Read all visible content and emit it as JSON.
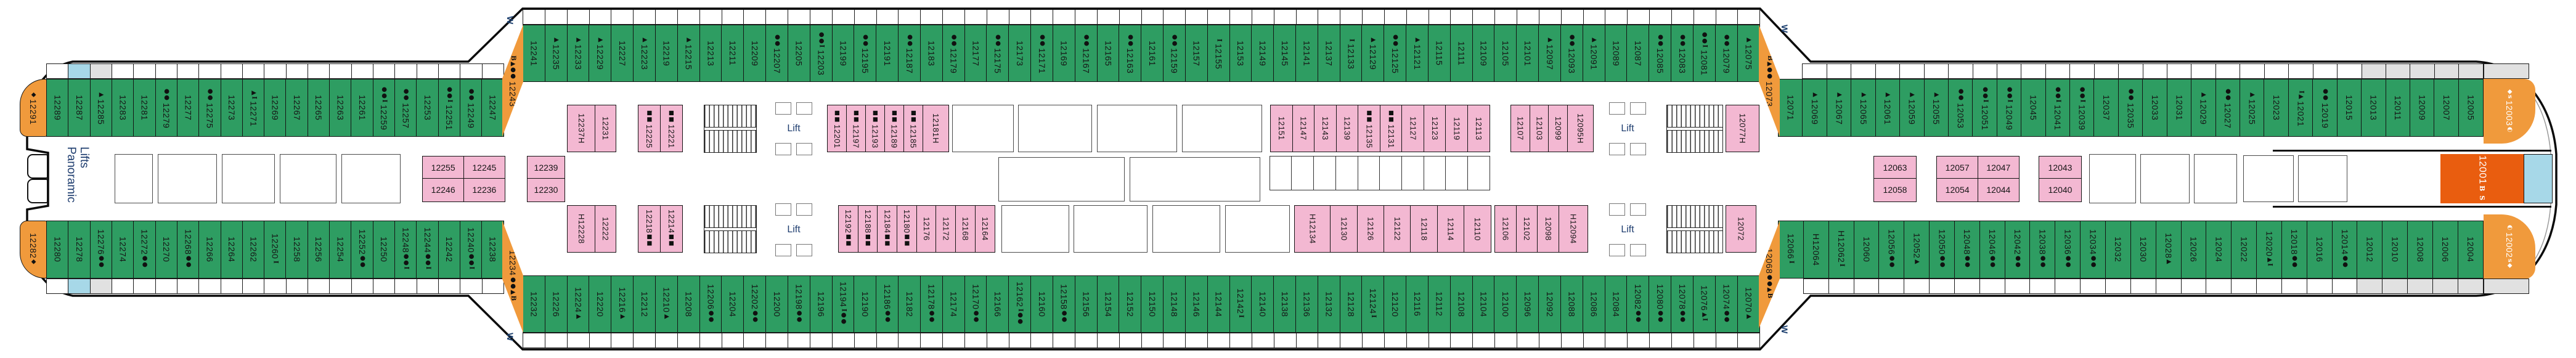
{
  "labels": {
    "panoramic_line1": "Panoramic",
    "panoramic_line2": "Lifts",
    "lift": "Lift",
    "w_mark": "W"
  },
  "colors": {
    "balcony_green": "#2e9d62",
    "inside_pink": "#f3b8d2",
    "suite_orange": "#f09a3c",
    "suite_deluxe": "#e95d0f",
    "highlight_blue": "#a7d8e8",
    "muted_gray": "#e1e1e1"
  },
  "rows": {
    "tl": {
      "base": "green",
      "cabins": [
        {
          "n": "12289"
        },
        {
          "n": "12287",
          "bal": "blue"
        },
        {
          "n": "12285",
          "pre": "▲",
          "bal": "gray"
        },
        {
          "n": "12283"
        },
        {
          "n": "12281"
        },
        {
          "n": "12279",
          "pre": "●●"
        },
        {
          "n": "12277"
        },
        {
          "n": "12275",
          "pre": "●●"
        },
        {
          "n": "12273"
        },
        {
          "n": "12271",
          "pre": "▲Ⅰ"
        },
        {
          "n": "12269"
        },
        {
          "n": "12267"
        },
        {
          "n": "12265"
        },
        {
          "n": "12263"
        },
        {
          "n": "12261"
        },
        {
          "n": "12259",
          "pre": "●●Ⅰ"
        },
        {
          "n": "12257",
          "pre": "●●"
        },
        {
          "n": "12253"
        },
        {
          "n": "12251",
          "pre": "●●Ⅰ"
        },
        {
          "n": "12249",
          "pre": "●●"
        },
        {
          "n": "12247"
        }
      ]
    },
    "tm": {
      "base": "green",
      "cabins": [
        {
          "n": "12241"
        },
        {
          "n": "12235",
          "pre": "▲"
        },
        {
          "n": "12233",
          "pre": "▲"
        },
        {
          "n": "12229",
          "pre": "▲"
        },
        {
          "n": "12227"
        },
        {
          "n": "12223",
          "pre": "▲"
        },
        {
          "n": "12219"
        },
        {
          "n": "12215",
          "pre": "▲"
        },
        {
          "n": "12213"
        },
        {
          "n": "12211"
        },
        {
          "n": "12209"
        },
        {
          "n": "12207",
          "pre": "●●"
        },
        {
          "n": "12205"
        },
        {
          "n": "12203",
          "pre": "●●Ⅰ"
        },
        {
          "n": "12199"
        },
        {
          "n": "12195",
          "pre": "●●"
        },
        {
          "n": "12191"
        },
        {
          "n": "12187",
          "pre": "●●"
        },
        {
          "n": "12183"
        },
        {
          "n": "12179",
          "pre": "●●"
        },
        {
          "n": "12177"
        },
        {
          "n": "12175",
          "pre": "●●"
        },
        {
          "n": "12173"
        },
        {
          "n": "12171",
          "pre": "●●"
        },
        {
          "n": "12169"
        },
        {
          "n": "12167",
          "pre": "●●"
        },
        {
          "n": "12165"
        },
        {
          "n": "12163",
          "pre": "●●"
        },
        {
          "n": "12161"
        },
        {
          "n": "12159",
          "pre": "●●"
        },
        {
          "n": "12157"
        },
        {
          "n": "12155",
          "pre": "Ⅰ"
        },
        {
          "n": "12153"
        },
        {
          "n": "12149"
        },
        {
          "n": "12145"
        },
        {
          "n": "12141"
        },
        {
          "n": "12137"
        },
        {
          "n": "12133",
          "pre": "Ⅰ"
        },
        {
          "n": "12129",
          "pre": "▲"
        },
        {
          "n": "12125",
          "pre": "●●"
        },
        {
          "n": "12121",
          "pre": "▲"
        },
        {
          "n": "12115"
        },
        {
          "n": "12111"
        },
        {
          "n": "12109"
        },
        {
          "n": "12105"
        },
        {
          "n": "12101"
        },
        {
          "n": "12097",
          "pre": "▲"
        },
        {
          "n": "12093",
          "pre": "●●"
        },
        {
          "n": "12091",
          "pre": "▲"
        },
        {
          "n": "12089"
        },
        {
          "n": "12087"
        },
        {
          "n": "12085",
          "pre": "●●"
        },
        {
          "n": "12083",
          "pre": "●●"
        },
        {
          "n": "12081",
          "pre": "●●Ⅰ"
        },
        {
          "n": "12079",
          "pre": "●●"
        },
        {
          "n": "12075",
          "pre": "▲"
        }
      ]
    },
    "tr": {
      "base": "green",
      "cabins": [
        {
          "n": "12071",
          "nobal": true
        },
        {
          "n": "12069",
          "pre": "▲"
        },
        {
          "n": "12067",
          "pre": "▲"
        },
        {
          "n": "12065",
          "pre": "▲"
        },
        {
          "n": "12061",
          "pre": "▲"
        },
        {
          "n": "12059",
          "pre": "▲"
        },
        {
          "n": "12055",
          "pre": "▲"
        },
        {
          "n": "12053",
          "pre": "●●"
        },
        {
          "n": "12051",
          "pre": "●●Ⅰ"
        },
        {
          "n": "12049",
          "pre": "●●Ⅰ"
        },
        {
          "n": "12045"
        },
        {
          "n": "12041",
          "pre": "●●Ⅰ"
        },
        {
          "n": "12039",
          "pre": "●●Ⅰ"
        },
        {
          "n": "12037"
        },
        {
          "n": "12035",
          "pre": "●●"
        },
        {
          "n": "12033"
        },
        {
          "n": "12031"
        },
        {
          "n": "12029",
          "pre": "▲"
        },
        {
          "n": "12027",
          "pre": "●●"
        },
        {
          "n": "12025",
          "pre": "▲"
        },
        {
          "n": "12023"
        },
        {
          "n": "12021",
          "pre": "Ⅰ▲"
        },
        {
          "n": "12019",
          "pre": "●●"
        },
        {
          "n": "12015"
        },
        {
          "n": "12013",
          "bal": "gray"
        },
        {
          "n": "12011",
          "bal": "gray"
        },
        {
          "n": "12009",
          "bal": "gray"
        },
        {
          "n": "12007",
          "bal": "gray"
        },
        {
          "n": "12005",
          "bal": "gray"
        }
      ]
    },
    "bl": {
      "base": "green",
      "cabins": [
        {
          "n": "12280"
        },
        {
          "n": "12278",
          "bal": "blue"
        },
        {
          "n": "12276",
          "suf": "●●",
          "bal": "gray"
        },
        {
          "n": "12274"
        },
        {
          "n": "12272",
          "suf": "●●"
        },
        {
          "n": "12270"
        },
        {
          "n": "12268",
          "suf": "●●"
        },
        {
          "n": "12266"
        },
        {
          "n": "12264"
        },
        {
          "n": "12262"
        },
        {
          "n": "12260",
          "suf": "Ⅰ"
        },
        {
          "n": "12258"
        },
        {
          "n": "12256"
        },
        {
          "n": "12254"
        },
        {
          "n": "12252",
          "suf": "●●"
        },
        {
          "n": "12250"
        },
        {
          "n": "12248",
          "suf": "●●Ⅰ"
        },
        {
          "n": "12244",
          "suf": "●●Ⅰ"
        },
        {
          "n": "12242"
        },
        {
          "n": "12240",
          "suf": "●●Ⅰ"
        },
        {
          "n": "12238"
        }
      ]
    },
    "bm": {
      "base": "green",
      "cabins": [
        {
          "n": "12232"
        },
        {
          "n": "12226"
        },
        {
          "n": "12224",
          "suf": "▲"
        },
        {
          "n": "12220"
        },
        {
          "n": "12216",
          "suf": "▲"
        },
        {
          "n": "12212"
        },
        {
          "n": "12210",
          "suf": "▲"
        },
        {
          "n": "12208"
        },
        {
          "n": "12206",
          "suf": "●●"
        },
        {
          "n": "12204"
        },
        {
          "n": "12202",
          "suf": "●●"
        },
        {
          "n": "12200"
        },
        {
          "n": "12198",
          "suf": "●●"
        },
        {
          "n": "12196"
        },
        {
          "n": "12194",
          "suf": "Ⅰ●●"
        },
        {
          "n": "12190"
        },
        {
          "n": "12186",
          "suf": "●●"
        },
        {
          "n": "12182"
        },
        {
          "n": "12178",
          "suf": "●●"
        },
        {
          "n": "12174"
        },
        {
          "n": "12170",
          "suf": "●●"
        },
        {
          "n": "12166"
        },
        {
          "n": "12162",
          "suf": "Ⅰ●●"
        },
        {
          "n": "12160"
        },
        {
          "n": "12158",
          "suf": "●●"
        },
        {
          "n": "12156"
        },
        {
          "n": "12154"
        },
        {
          "n": "12152"
        },
        {
          "n": "12150"
        },
        {
          "n": "12148"
        },
        {
          "n": "12146"
        },
        {
          "n": "12144"
        },
        {
          "n": "12142",
          "suf": "Ⅰ"
        },
        {
          "n": "12140"
        },
        {
          "n": "12138"
        },
        {
          "n": "12136"
        },
        {
          "n": "12132"
        },
        {
          "n": "12128"
        },
        {
          "n": "12124",
          "suf": "Ⅰ"
        },
        {
          "n": "12120"
        },
        {
          "n": "12116"
        },
        {
          "n": "12112"
        },
        {
          "n": "12108"
        },
        {
          "n": "12104"
        },
        {
          "n": "12100"
        },
        {
          "n": "12096"
        },
        {
          "n": "12092"
        },
        {
          "n": "12088"
        },
        {
          "n": "12086"
        },
        {
          "n": "12084"
        },
        {
          "n": "12082",
          "suf": "●●"
        },
        {
          "n": "12080",
          "suf": "●●"
        },
        {
          "n": "12078",
          "suf": "●●"
        },
        {
          "n": "12076",
          "suf": "▲Ⅰ"
        },
        {
          "n": "12074",
          "suf": "●●"
        },
        {
          "n": "12070",
          "suf": "▲"
        }
      ]
    },
    "br": {
      "base": "green",
      "cabins": [
        {
          "n": "12066",
          "suf": "Ⅰ",
          "nobal": true
        },
        {
          "n": "12064",
          "H": "pre"
        },
        {
          "n": "12062",
          "H": "pre",
          "suf": "Ⅰ"
        },
        {
          "n": "12060"
        },
        {
          "n": "12056",
          "suf": "●●"
        },
        {
          "n": "12052",
          "suf": "▲"
        },
        {
          "n": "12050",
          "suf": "●●"
        },
        {
          "n": "12048",
          "suf": "●●"
        },
        {
          "n": "12046",
          "suf": "●●"
        },
        {
          "n": "12042",
          "suf": "●●"
        },
        {
          "n": "12038",
          "suf": "●●"
        },
        {
          "n": "12036",
          "suf": "●●"
        },
        {
          "n": "12034",
          "suf": "●●"
        },
        {
          "n": "12032"
        },
        {
          "n": "12030"
        },
        {
          "n": "12028",
          "suf": "▲"
        },
        {
          "n": "12026"
        },
        {
          "n": "12024"
        },
        {
          "n": "12022"
        },
        {
          "n": "12020",
          "suf": "▲Ⅰ"
        },
        {
          "n": "12018",
          "suf": "●●"
        },
        {
          "n": "12016"
        },
        {
          "n": "12014",
          "suf": "●●"
        },
        {
          "n": "12012",
          "bal": "gray"
        },
        {
          "n": "12010",
          "bal": "gray"
        },
        {
          "n": "12008",
          "bal": "gray"
        },
        {
          "n": "12006",
          "bal": "gray"
        },
        {
          "n": "12004",
          "bal": "gray"
        }
      ]
    }
  },
  "pink_top_blocks": [
    {
      "cabins": [
        {
          "n": "12237",
          "H": "suf",
          "fw": 1.35
        },
        {
          "n": "12231"
        }
      ]
    },
    {
      "cabins": [
        {
          "n": "12225",
          "pre": "■■"
        },
        {
          "n": "12221",
          "pre": "■■"
        }
      ]
    },
    {
      "cabins": [
        {
          "n": "12201",
          "pre": "■■"
        },
        {
          "n": "12197",
          "pre": "■■"
        },
        {
          "n": "12193",
          "pre": "■■"
        },
        {
          "n": "12189",
          "pre": "■■"
        },
        {
          "n": "12185",
          "pre": "■■"
        },
        {
          "n": "12181",
          "H": "suf",
          "fw": 1.35
        }
      ]
    },
    {
      "cabins": [
        {
          "n": "12151"
        },
        {
          "n": "12147"
        },
        {
          "n": "12143"
        },
        {
          "n": "12139"
        },
        {
          "n": "12135",
          "pre": "■■"
        },
        {
          "n": "12131",
          "pre": "■■"
        },
        {
          "n": "12127"
        },
        {
          "n": "12123"
        },
        {
          "n": "12119"
        },
        {
          "n": "12113"
        }
      ]
    },
    {
      "cabins": [
        {
          "n": "12107"
        },
        {
          "n": "12103"
        },
        {
          "n": "12099"
        },
        {
          "n": "12095",
          "H": "suf",
          "fw": 1.35
        }
      ]
    },
    {
      "cabins": [
        {
          "n": "12077",
          "H": "suf"
        }
      ]
    }
  ],
  "pink_bottom_blocks": [
    {
      "cabins": [
        {
          "n": "12228",
          "H": "pre",
          "fw": 1.35
        },
        {
          "n": "12222"
        }
      ]
    },
    {
      "cabins": [
        {
          "n": "12218",
          "suf": "■■"
        },
        {
          "n": "12214",
          "suf": "■■"
        }
      ]
    },
    {
      "cabins": [
        {
          "n": "12192",
          "suf": "■■"
        },
        {
          "n": "12188",
          "suf": "■■"
        },
        {
          "n": "12184",
          "suf": "■■"
        },
        {
          "n": "12180",
          "suf": "■■"
        },
        {
          "n": "12176"
        },
        {
          "n": "12172"
        },
        {
          "n": "12168"
        },
        {
          "n": "12164"
        }
      ]
    },
    {
      "cabins": [
        {
          "n": "12134",
          "H": "pre",
          "fw": 1.35
        },
        {
          "n": "12130"
        },
        {
          "n": "12126"
        },
        {
          "n": "12122"
        },
        {
          "n": "12118"
        },
        {
          "n": "12114"
        },
        {
          "n": "12110"
        }
      ]
    },
    {
      "cabins": [
        {
          "n": "12106"
        },
        {
          "n": "12102"
        },
        {
          "n": "12098"
        },
        {
          "n": "12094",
          "H": "pre",
          "fw": 1.35
        }
      ]
    },
    {
      "cabins": [
        {
          "n": "12072"
        }
      ]
    }
  ],
  "center_blocks": [
    {
      "rows": [
        [
          "12255",
          "12245"
        ],
        [
          "12246",
          "12236"
        ]
      ]
    },
    {
      "rows": [
        [
          "12239"
        ],
        [
          "12230"
        ]
      ]
    },
    {
      "rows": [
        [
          "12063"
        ],
        [
          "12058"
        ]
      ]
    },
    {
      "rows": [
        [
          "12057",
          "12047"
        ],
        [
          "12054",
          "12044"
        ]
      ]
    },
    {
      "rows": [
        [
          "12043"
        ],
        [
          "12040"
        ]
      ]
    }
  ],
  "bow_cabins": {
    "top": {
      "n": "12291",
      "pre": "◆"
    },
    "bottom": {
      "n": "12282",
      "suf": "◆"
    }
  },
  "corner_cabins": {
    "top_left": {
      "n": "12243",
      "pre": "B▲●●"
    },
    "bottom_left": {
      "n": "12234",
      "suf": "●●▲B"
    },
    "top_right": {
      "n": "12073",
      "pre": "B▲●●"
    },
    "bottom_right": {
      "n": "12068",
      "suf": "●●▲B"
    }
  },
  "stern_cabins": {
    "top": {
      "n": "12003",
      "pre": "◆s",
      "suf": "◐"
    },
    "mid": {
      "n": "12001",
      "side": "B S"
    },
    "bottom": {
      "n": "12002",
      "pre": "◐",
      "suf": "s◆"
    }
  }
}
